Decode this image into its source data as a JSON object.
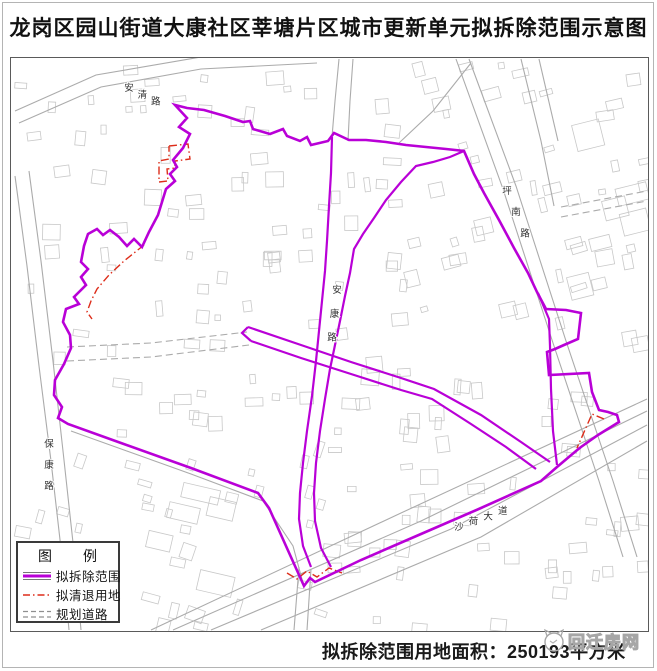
{
  "title": "龙岗区园山街道大康社区莘塘片区城市更新单元拟拆除范围示意图",
  "caption": {
    "text": "拟拆除范围用地面积：250193平方米"
  },
  "watermark": {
    "text": "回迁房网"
  },
  "legend": {
    "title": "图　　例",
    "items": [
      {
        "key": "demolition",
        "label": "拟拆除范围"
      },
      {
        "key": "clearance",
        "label": "拟清退用地"
      },
      {
        "key": "planned-road",
        "label": "规划道路"
      }
    ]
  },
  "colors": {
    "boundary": "#B900D7",
    "clearance": "#DD2D1A",
    "road": "#ABABAB",
    "building": "#C8C8C8",
    "label": "#333333"
  },
  "map": {
    "frame": {
      "x": 10,
      "y": 57,
      "w": 637,
      "h": 573
    },
    "outer_boundary": [
      [
        174,
        104
      ],
      [
        186,
        117
      ],
      [
        178,
        126
      ],
      [
        189,
        133
      ],
      [
        182,
        147
      ],
      [
        172,
        159
      ],
      [
        176,
        166
      ],
      [
        169,
        173
      ],
      [
        174,
        180
      ],
      [
        165,
        188
      ],
      [
        157,
        214
      ],
      [
        148,
        231
      ],
      [
        141,
        246
      ],
      [
        133,
        238
      ],
      [
        126,
        245
      ],
      [
        118,
        236
      ],
      [
        109,
        229
      ],
      [
        102,
        234
      ],
      [
        96,
        228
      ],
      [
        87,
        233
      ],
      [
        83,
        245
      ],
      [
        80,
        261
      ],
      [
        87,
        268
      ],
      [
        80,
        276
      ],
      [
        85,
        284
      ],
      [
        73,
        296
      ],
      [
        78,
        303
      ],
      [
        65,
        308
      ],
      [
        62,
        321
      ],
      [
        69,
        334
      ],
      [
        70,
        347
      ],
      [
        63,
        363
      ],
      [
        54,
        379
      ],
      [
        53,
        394
      ],
      [
        61,
        406
      ],
      [
        57,
        417
      ],
      [
        67,
        423
      ],
      [
        120,
        442
      ],
      [
        190,
        467
      ],
      [
        257,
        492
      ],
      [
        268,
        507
      ],
      [
        285,
        545
      ],
      [
        303,
        585
      ],
      [
        309,
        577
      ],
      [
        314,
        581
      ],
      [
        360,
        559
      ],
      [
        420,
        533
      ],
      [
        480,
        507
      ],
      [
        540,
        480
      ],
      [
        556,
        466
      ],
      [
        575,
        450
      ],
      [
        580,
        446
      ],
      [
        597,
        434
      ],
      [
        618,
        421
      ],
      [
        616,
        414
      ],
      [
        607,
        411
      ],
      [
        598,
        409
      ],
      [
        591,
        391
      ],
      [
        588,
        372
      ],
      [
        548,
        374
      ],
      [
        546,
        351
      ],
      [
        554,
        348
      ],
      [
        563,
        344
      ],
      [
        577,
        338
      ],
      [
        580,
        312
      ],
      [
        565,
        309
      ],
      [
        545,
        308
      ],
      [
        536,
        291
      ],
      [
        527,
        272
      ],
      [
        513,
        247
      ],
      [
        498,
        219
      ],
      [
        483,
        192
      ],
      [
        473,
        173
      ],
      [
        463,
        150
      ],
      [
        445,
        148
      ],
      [
        425,
        146
      ],
      [
        405,
        144
      ],
      [
        385,
        141
      ],
      [
        365,
        139
      ],
      [
        348,
        139
      ],
      [
        333,
        132
      ],
      [
        327,
        140
      ],
      [
        310,
        144
      ],
      [
        306,
        136
      ],
      [
        299,
        140
      ],
      [
        286,
        135
      ],
      [
        282,
        128
      ],
      [
        269,
        133
      ],
      [
        252,
        128
      ],
      [
        249,
        120
      ],
      [
        242,
        121
      ],
      [
        224,
        115
      ],
      [
        203,
        109
      ],
      [
        186,
        107
      ]
    ],
    "inner_lines": [
      {
        "name": "corridor-west",
        "pts": [
          [
            331,
            136
          ],
          [
            330,
            172
          ],
          [
            328,
            205
          ],
          [
            326,
            240
          ],
          [
            324,
            270
          ],
          [
            321,
            300
          ],
          [
            318,
            330
          ],
          [
            315,
            360
          ],
          [
            311,
            395
          ],
          [
            306,
            430
          ],
          [
            302,
            462
          ],
          [
            299,
            492
          ],
          [
            298,
            518
          ],
          [
            302,
            545
          ],
          [
            310,
            566
          ]
        ]
      },
      {
        "name": "corridor-east",
        "pts": [
          [
            463,
            150
          ],
          [
            449,
            156
          ],
          [
            432,
            161
          ],
          [
            415,
            165
          ],
          [
            400,
            181
          ],
          [
            385,
            199
          ],
          [
            373,
            217
          ],
          [
            362,
            233
          ],
          [
            353,
            248
          ],
          [
            349,
            272
          ],
          [
            344,
            295
          ],
          [
            339,
            320
          ],
          [
            334,
            344
          ],
          [
            329,
            368
          ],
          [
            324,
            398
          ],
          [
            319,
            430
          ],
          [
            315,
            462
          ],
          [
            313,
            492
          ],
          [
            314,
            520
          ],
          [
            320,
            547
          ],
          [
            330,
            566
          ]
        ]
      },
      {
        "name": "cross-north",
        "pts": [
          [
            247,
            326
          ],
          [
            300,
            344
          ],
          [
            350,
            361
          ],
          [
            400,
            377
          ],
          [
            433,
            388
          ],
          [
            480,
            414
          ],
          [
            520,
            441
          ],
          [
            549,
            461
          ]
        ]
      },
      {
        "name": "cross-south",
        "pts": [
          [
            250,
            340
          ],
          [
            300,
            357
          ],
          [
            350,
            373
          ],
          [
            400,
            389
          ],
          [
            431,
            398
          ],
          [
            470,
            423
          ],
          [
            505,
            446
          ],
          [
            535,
            468
          ]
        ]
      },
      {
        "name": "cross-cap",
        "pts": [
          [
            247,
            326
          ],
          [
            241,
            332
          ],
          [
            250,
            340
          ]
        ]
      },
      {
        "name": "lobe-inner",
        "pts": [
          [
            556,
            464
          ],
          [
            552,
            430
          ],
          [
            550,
            388
          ],
          [
            549,
            345
          ],
          [
            548,
            318
          ],
          [
            537,
            292
          ]
        ]
      }
    ],
    "clearance_lines": [
      {
        "pts": [
          [
            168,
            145
          ],
          [
            187,
            143
          ],
          [
            189,
            158
          ],
          [
            174,
            160
          ],
          [
            174,
            167
          ],
          [
            166,
            168
          ],
          [
            167,
            180
          ],
          [
            158,
            181
          ],
          [
            158,
            160
          ],
          [
            168,
            158
          ],
          [
            168,
            145
          ]
        ]
      },
      {
        "pts": [
          [
            143,
            244
          ],
          [
            123,
            260
          ],
          [
            108,
            274
          ],
          [
            96,
            288
          ],
          [
            90,
            300
          ],
          [
            86,
            311
          ],
          [
            91,
            318
          ]
        ]
      },
      {
        "pts": [
          [
            603,
            418
          ],
          [
            591,
            413
          ],
          [
            576,
            447
          ]
        ]
      },
      {
        "pts": [
          [
            286,
            572
          ],
          [
            296,
            578
          ],
          [
            306,
            570
          ],
          [
            316,
            576
          ],
          [
            328,
            567
          ],
          [
            341,
            572
          ]
        ]
      }
    ],
    "gray_roads": [
      {
        "pts": [
          [
            18,
            122
          ],
          [
            100,
            86
          ],
          [
            200,
            68
          ],
          [
            316,
            62
          ]
        ]
      },
      {
        "pts": [
          [
            14,
            110
          ],
          [
            95,
            74
          ],
          [
            200,
            56
          ],
          [
            300,
            50
          ]
        ]
      },
      {
        "pts": [
          [
            468,
            58
          ],
          [
            515,
            185
          ],
          [
            565,
            340
          ],
          [
            612,
            480
          ],
          [
            636,
            556
          ]
        ]
      },
      {
        "pts": [
          [
            455,
            58
          ],
          [
            502,
            188
          ],
          [
            552,
            342
          ],
          [
            598,
            480
          ],
          [
            622,
            556
          ]
        ]
      },
      {
        "pts": [
          [
            28,
            170
          ],
          [
            40,
            260
          ],
          [
            52,
            360
          ],
          [
            62,
            450
          ],
          [
            74,
            560
          ],
          [
            80,
            629
          ]
        ]
      },
      {
        "pts": [
          [
            14,
            175
          ],
          [
            26,
            265
          ],
          [
            38,
            365
          ],
          [
            50,
            460
          ],
          [
            62,
            565
          ],
          [
            68,
            629
          ]
        ]
      },
      {
        "pts": [
          [
            150,
            629
          ],
          [
            400,
            512
          ],
          [
            646,
            398
          ]
        ]
      },
      {
        "pts": [
          [
            172,
            629
          ],
          [
            420,
            520
          ],
          [
            646,
            410
          ]
        ]
      },
      {
        "pts": [
          [
            210,
            629
          ],
          [
            450,
            528
          ],
          [
            646,
            424
          ]
        ]
      },
      {
        "pts": [
          [
            260,
            629
          ],
          [
            480,
            536
          ],
          [
            646,
            440
          ]
        ]
      },
      {
        "pts": [
          [
            338,
            58
          ],
          [
            334,
            100
          ],
          [
            331,
            136
          ]
        ]
      },
      {
        "pts": [
          [
            352,
            58
          ],
          [
            349,
            100
          ],
          [
            347,
            140
          ]
        ]
      },
      {
        "pts": [
          [
            66,
            346
          ],
          [
            150,
            342
          ],
          [
            246,
            331
          ]
        ],
        "dash": true
      },
      {
        "pts": [
          [
            66,
            360
          ],
          [
            150,
            356
          ],
          [
            248,
            344
          ]
        ],
        "dash": true
      },
      {
        "pts": [
          [
            293,
            629
          ],
          [
            298,
            566
          ]
        ]
      },
      {
        "pts": [
          [
            306,
            629
          ],
          [
            310,
            568
          ]
        ]
      },
      {
        "pts": [
          [
            470,
            62
          ],
          [
            432,
            110
          ],
          [
            398,
            142
          ]
        ]
      },
      {
        "pts": [
          [
            520,
            58
          ],
          [
            540,
            140
          ],
          [
            553,
            205
          ]
        ]
      },
      {
        "pts": [
          [
            538,
            58
          ],
          [
            557,
            140
          ]
        ]
      },
      {
        "pts": [
          [
            70,
            430
          ],
          [
            190,
            473
          ],
          [
            262,
            500
          ],
          [
            292,
            545
          ],
          [
            302,
            582
          ]
        ]
      },
      {
        "pts": [
          [
            560,
            206
          ],
          [
            646,
            190
          ]
        ],
        "dash": true
      },
      {
        "pts": [
          [
            560,
            216
          ],
          [
            646,
            200
          ]
        ],
        "dash": true
      }
    ],
    "road_labels": [
      {
        "key": "anqing",
        "text": "安清路",
        "x": 128,
        "y": 90,
        "angle": 27,
        "step": 15
      },
      {
        "key": "pingnan",
        "text": "坪南路",
        "x": 506,
        "y": 193,
        "angle": 67,
        "step": 23
      },
      {
        "key": "baokang",
        "text": "保康路",
        "x": 48,
        "y": 446,
        "angle": 90,
        "step": 21
      },
      {
        "key": "ankang",
        "text": "安康路",
        "x": 336,
        "y": 292,
        "angle": 96,
        "step": 24
      },
      {
        "key": "shahe",
        "text": "沙荷大道",
        "x": 458,
        "y": 529,
        "angle": -20,
        "step": 15.5
      }
    ]
  }
}
